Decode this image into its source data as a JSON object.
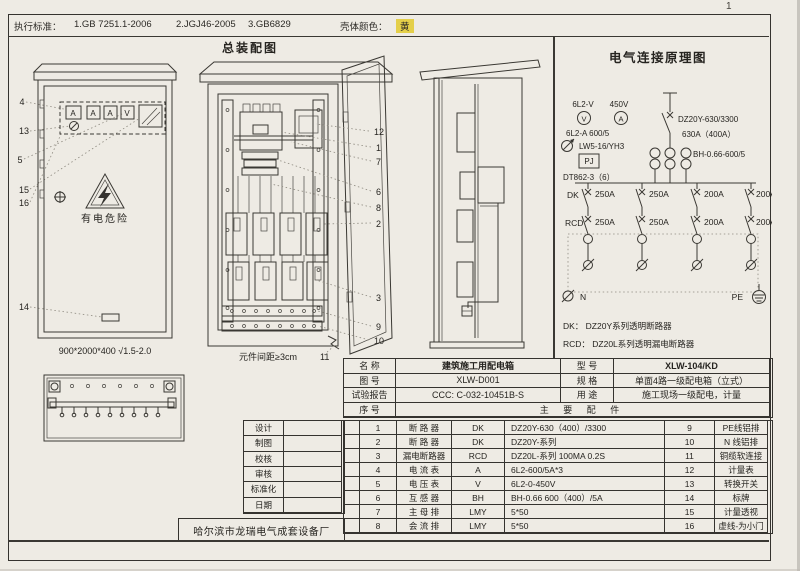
{
  "page": {
    "number": "1"
  },
  "standards_bar": {
    "label": "执行标准：",
    "items": [
      "1.GB 7251.1-2006",
      "2.JGJ46-2005",
      "3.GB6829"
    ],
    "shell_color_label": "壳体颜色：",
    "shell_color_value": "黄",
    "shell_color_hex": "#e4cf49"
  },
  "assembly": {
    "title": "总装配图",
    "front_view": {
      "callouts": [
        "4",
        "13",
        "5",
        "15",
        "16",
        "14"
      ],
      "meters": [
        "A",
        "A",
        "A",
        "V"
      ],
      "warning": "有电危险",
      "caption": "900*2000*400 √1.5-2.0"
    },
    "open_view": {
      "callouts": [
        "12",
        "1",
        "7",
        "6",
        "8",
        "2",
        "3",
        "9",
        "10"
      ],
      "caption": "元件间距≥3cm",
      "caption_callout": "11"
    }
  },
  "schematic": {
    "title": "电气连接原理图",
    "voltmeter_label": "6L2-V",
    "voltage": "450V",
    "v_symbol": "V",
    "a_symbol": "A",
    "ammeter_label": "6L2-A 600/5",
    "switch_label": "LW5-16/YH3",
    "meter_box": "PJ",
    "energy_meter": "DT862-3（6）",
    "main_breaker_model": "DZ20Y-630/3300",
    "main_breaker_rating": "630A（400A）",
    "ct_label": "BH-0.66-600/5",
    "dk_label": "DK",
    "rcd_label": "RCD",
    "dk_ratings": [
      "250A",
      "250A",
      "200A",
      "200A"
    ],
    "rcd_ratings": [
      "250A",
      "250A",
      "200A",
      "200A"
    ],
    "neutral_label": "N",
    "pe_label": "PE",
    "legend": [
      "DK：  DZ20Y系列透明断路器",
      "RCD： DZ20L系列透明漏电断路器"
    ]
  },
  "title_block": {
    "rows": [
      "设计",
      "制图",
      "校核",
      "审核",
      "标准化",
      "日期"
    ],
    "company": "哈尔滨市龙瑞电气成套设备厂"
  },
  "info_table": {
    "name_label": "名   称",
    "name_value": "建筑施工用配电箱",
    "model_label": "型   号",
    "model_value": "XLW-104/KD",
    "drawing_label": "图   号",
    "drawing_value": "XLW-D001",
    "spec_label": "规   格",
    "spec_value": "单面4路一级配电箱（立式）",
    "report_label": "试验报告",
    "report_value": "CCC: C-032-10451B-S",
    "use_label": "用   途",
    "use_value": "施工现场一级配电，计量",
    "seq_label": "序   号",
    "parts_header": "主  要  配  件"
  },
  "parts": [
    {
      "no": "1",
      "name": "断 路 器",
      "code": "DK",
      "spec": "DZ20Y-630（400）/3300",
      "no2": "9",
      "name2": "PE线铝排"
    },
    {
      "no": "2",
      "name": "断 路 器",
      "code": "DK",
      "spec": "DZ20Y-系列",
      "no2": "10",
      "name2": "N 线铝排"
    },
    {
      "no": "3",
      "name": "漏电断路器",
      "code": "RCD",
      "spec": "DZ20L-系列  100MA 0.2S",
      "no2": "11",
      "name2": "铜缆软连接"
    },
    {
      "no": "4",
      "name": "电 流 表",
      "code": "A",
      "spec": "6L2-600/5A*3",
      "no2": "12",
      "name2": "计量表"
    },
    {
      "no": "5",
      "name": "电 压 表",
      "code": "V",
      "spec": "6L2-0-450V",
      "no2": "13",
      "name2": "转换开关"
    },
    {
      "no": "6",
      "name": "互 感 器",
      "code": "BH",
      "spec": "BH-0.66 600（400）/5A",
      "no2": "14",
      "name2": "标牌"
    },
    {
      "no": "7",
      "name": "主 母 排",
      "code": "LMY",
      "spec": "5*50",
      "no2": "15",
      "name2": "计量透视"
    },
    {
      "no": "8",
      "name": "会 流 排",
      "code": "LMY",
      "spec": "5*50",
      "no2": "16",
      "name2": "虚线-为小门"
    }
  ]
}
